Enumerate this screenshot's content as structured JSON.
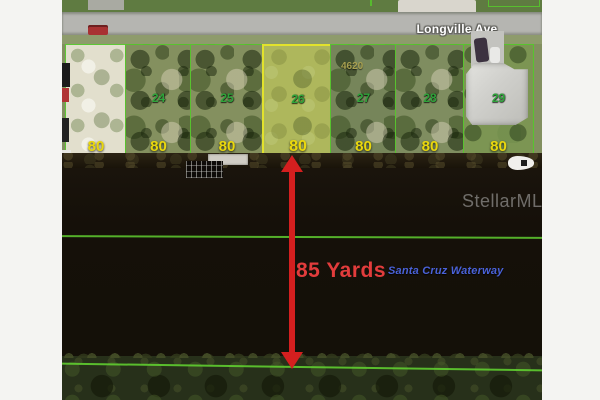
{
  "road": {
    "name": "Longville Ave"
  },
  "lots": [
    {
      "number": "",
      "width_label": "80"
    },
    {
      "number": "24",
      "width_label": "80"
    },
    {
      "number": "25",
      "width_label": "80"
    },
    {
      "number": "26",
      "width_label": "80",
      "highlighted": true
    },
    {
      "number": "27",
      "width_label": "80",
      "parcel_tag": "4620"
    },
    {
      "number": "28",
      "width_label": "80"
    },
    {
      "number": "29",
      "width_label": "80",
      "has_house": true
    }
  ],
  "waterway": {
    "name": "Santa Cruz Waterway",
    "width_measurement": "85 Yards"
  },
  "watermark": {
    "text": "StellarMLS"
  },
  "colors": {
    "lot_line": "#52bd28",
    "highlight_outline": "#e2e22c",
    "lot_number_text": "#2ea43a",
    "width_label_text": "#e9d70d",
    "arrow": "#d41f1f",
    "measurement_text": "#e23c3c",
    "waterway_text": "#4a62d8",
    "road_label_text": "#ffffff",
    "watermark_text": "#b9b9b9"
  }
}
